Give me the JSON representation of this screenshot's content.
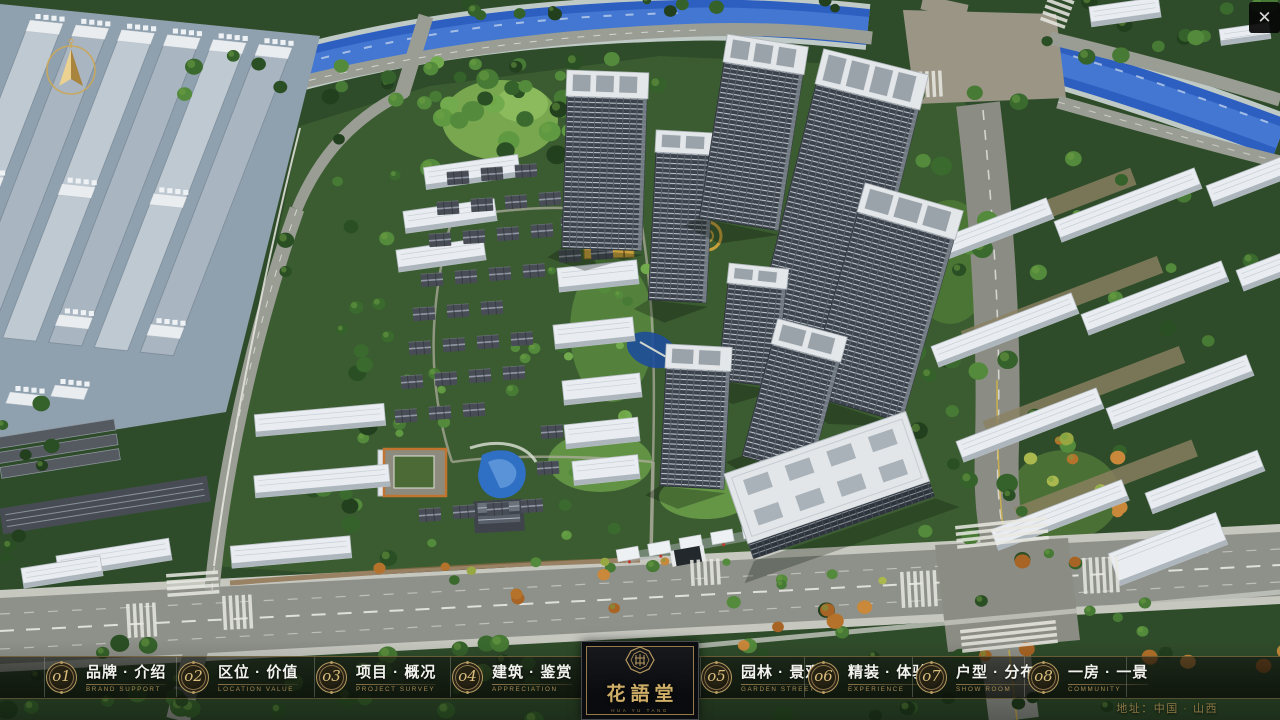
{
  "app": {
    "close_label": "✕"
  },
  "menu": {
    "items": [
      {
        "num": "o1",
        "zh": "品牌 · 介绍",
        "en": "BRAND SUPPORT"
      },
      {
        "num": "o2",
        "zh": "区位 · 价值",
        "en": "LOCATION VALUE"
      },
      {
        "num": "o3",
        "zh": "项目 · 概况",
        "en": "PROJECT SURVEY"
      },
      {
        "num": "o4",
        "zh": "建筑 · 鉴赏",
        "en": "APPRECIATION"
      },
      {
        "num": "o5",
        "zh": "园林 · 景观",
        "en": "GARDEN STREET"
      },
      {
        "num": "o6",
        "zh": "精装 · 体验",
        "en": "EXPERIENCE"
      },
      {
        "num": "o7",
        "zh": "户型 · 分布",
        "en": "SHOW ROOM"
      },
      {
        "num": "o8",
        "zh": "一房 · 一景",
        "en": "COMMUNITY"
      }
    ]
  },
  "logo": {
    "title": "花語堂",
    "subtitle": "HUA YU TANG"
  },
  "footer": {
    "address": "地址：中国 · 山西"
  },
  "colors": {
    "accent_gold": "#c9ab66",
    "bar_line": "#8a744a",
    "menu_zh": "#f2f2ee",
    "menu_en": "#a58c54",
    "address": "#8d7946",
    "river_blue": "#2c5fc0",
    "foliage_green": "#2e5527",
    "road_gray": "#8e9189",
    "close_bg": "#0a0a0a",
    "close_x": "#d6d6d6"
  }
}
